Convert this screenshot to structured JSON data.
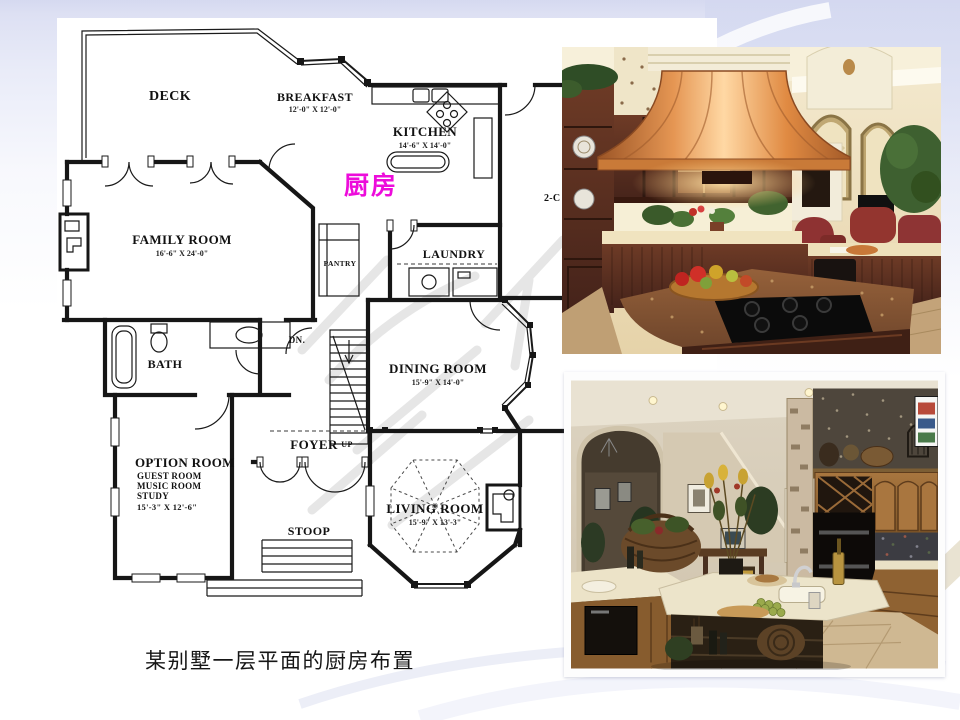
{
  "slide": {
    "caption": "某别墅一层平面的厨房布置",
    "kitchen_callout": "厨房"
  },
  "colors": {
    "callout_magenta": "#ed0cdb",
    "background_top": "#d5d9f0",
    "plan_ink": "#161616"
  },
  "floorplan": {
    "deck": {
      "label": "DECK"
    },
    "breakfast": {
      "label": "BREAKFAST",
      "dims": "12'-0\" X 12'-0\""
    },
    "kitchen": {
      "label": "KITCHEN",
      "dims": "14'-6\" X 14'-0\""
    },
    "family_room": {
      "label": "FAMILY ROOM",
      "dims": "16'-6\" X 24'-0\""
    },
    "pantry": {
      "label": "PANTRY"
    },
    "laundry": {
      "label": "LAUNDRY"
    },
    "bath": {
      "label": "BATH"
    },
    "dining_room": {
      "label": "DINING ROOM",
      "dims": "15'-9\" X 14'-0\""
    },
    "option_room": {
      "label": "OPTION ROOM",
      "alt1": "GUEST ROOM",
      "alt2": "MUSIC ROOM",
      "alt3": "STUDY",
      "dims": "15'-3\" X 12'-6\""
    },
    "foyer": {
      "label": "FOYER"
    },
    "stoop": {
      "label": "STOOP"
    },
    "living_room": {
      "label": "LIVING ROOM",
      "dims": "15'-9\" X 13'-3\""
    },
    "stairs": {
      "down": "DN.",
      "up": "UP"
    },
    "garage_label_partial": "2-C"
  }
}
